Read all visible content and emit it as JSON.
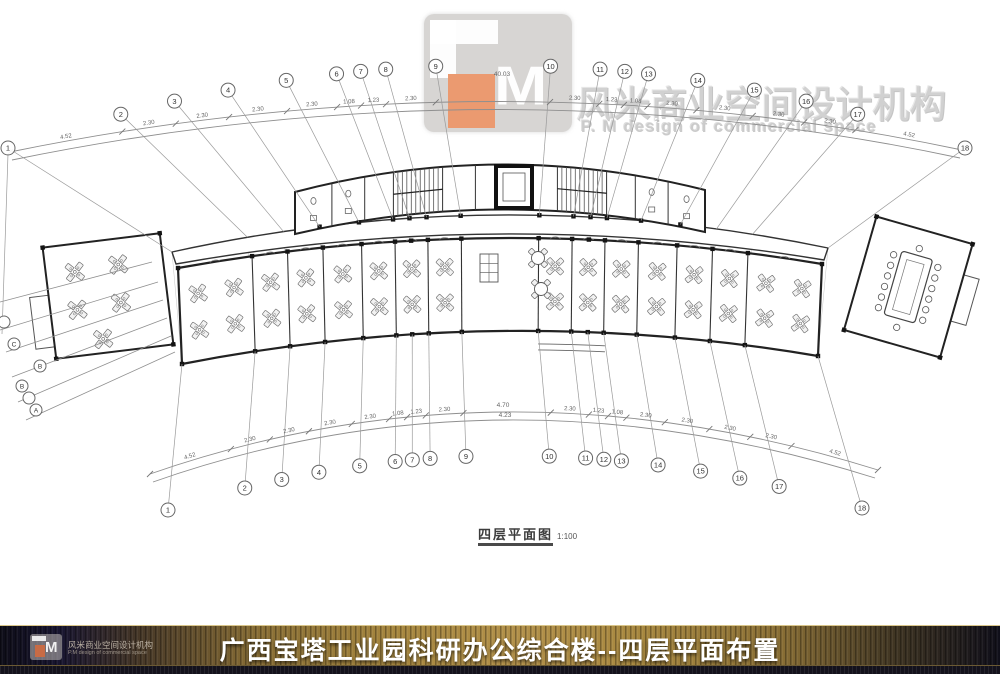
{
  "watermark": {
    "m": "M",
    "cn": "风米商业空间设计机构",
    "en": "P. M design of commercial space"
  },
  "caption": {
    "title": "四层平面图",
    "scale": "1:100"
  },
  "footer": {
    "title": "广西宝塔工业园科研办公综合楼--四层平面布置",
    "m": "M",
    "cn": "风米商业空间设计机构",
    "en": "P.M design of commercial space"
  },
  "grid": {
    "top_labels": [
      "1",
      "2",
      "3",
      "4",
      "5",
      "6",
      "7",
      "8",
      "9",
      "10",
      "11",
      "12",
      "13",
      "14",
      "15",
      "16",
      "17",
      "18"
    ],
    "bottom_labels": [
      "1",
      "2",
      "3",
      "4",
      "5",
      "6",
      "7",
      "8",
      "9",
      "10",
      "11",
      "12",
      "13",
      "14",
      "15",
      "16",
      "17",
      "18"
    ],
    "left_labels": [
      "",
      "C",
      "B",
      "B",
      "",
      "A"
    ],
    "dims": [
      "4.52",
      "2.30",
      "2.30",
      "2.30",
      "2.30",
      "1.08",
      "1.23",
      "2.30",
      "",
      "2.30",
      "1.23",
      "1.08",
      "2.30",
      "2.30",
      "2.30",
      "2.30",
      "4.52"
    ],
    "dim_top_center": "40.03",
    "dim_bottom_center_upper": "4.70",
    "dim_bottom_center_lower": "4.23"
  },
  "colors": {
    "plan_line": "#2a2a2a",
    "dim_line": "#8a8a8a",
    "accent_orange": "#eb9a70",
    "banner_gold": "#a8883f",
    "banner_dark": "#14121c"
  }
}
